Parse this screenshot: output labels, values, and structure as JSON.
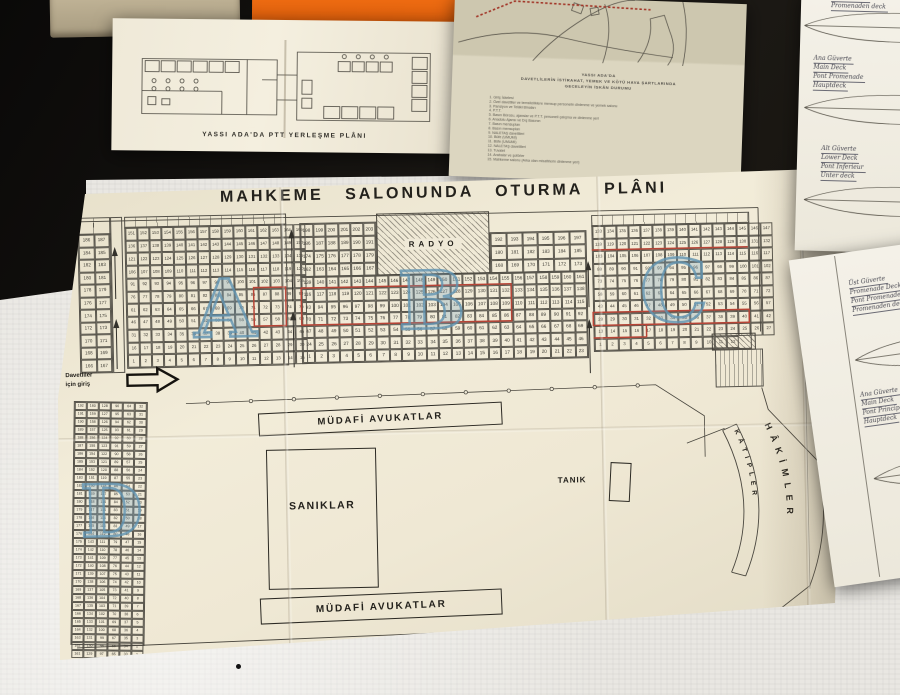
{
  "scene": {
    "colors": {
      "table_dark": "#161310",
      "cloth_light": "#e9e7e2",
      "folder_orange": "#e86410",
      "book_tan": "#b3a78d",
      "plan_paper": "#efe8d4",
      "red_mark": "#b84436",
      "blue_stamp": "#6fa0bd"
    }
  },
  "ptt_plan": {
    "caption": "YASSI ADA'DA PTT YERLEŞME PLÂNI"
  },
  "info_sheet": {
    "heading": [
      "YASSI ADA'DA",
      "DAVETLİLERİN İSTİRAHAT, YEMEK VE KÖTÜ HAVA ŞARTLARINDA",
      "GECELEYİN İSKÂN DURUMU"
    ],
    "items": [
      "Giriş İskelesi",
      "Özel davetliler ve temsilciliklere mensup personelin dinlenme ve yemek salonu",
      "Pansiyon ve Telâki Binaları",
      "P.T.T.",
      "Basın Bürosu, ajanslar ve P.T.T. personeli çalışma ve dinlenme yeri",
      "Anadolu Ajansı ve Dış Basının",
      "Basın mensupları",
      "Basın mensupları",
      "NALETAŞ davetlileri",
      "Büfe (UMUMİ)",
      "Büfe (UMUMİ)",
      "NALETAŞ davetlileri",
      "Tuvalet",
      "Arabalar ve şoförler",
      "Mahkeme salonu (Arka olan misafirlerin dinlenme yeri)"
    ]
  },
  "court_plan": {
    "title": "MAHKEME SALONUNDA OTURMA PLÂNI",
    "entrance_line1": "Davetliler",
    "entrance_line2": "için giriş",
    "radyo_label": "RADYO",
    "saniklar_label": "SANIKLAR",
    "tanik_label": "TANIK",
    "mudafi_top_label": "MÜDAFİ AVUKATLAR",
    "mudafi_bottom_label": "MÜDAFİ AVUKATLAR",
    "hakimler_label": "HÂKİMLER",
    "katipler_label": "KÂTİPLER",
    "stamp_a": "A",
    "stamp_b": "B",
    "stamp_c": "C",
    "stamp_d": "D",
    "grids": {
      "a_pairs": {
        "cols": 2,
        "row_ranges": [
          [
            186,
            187
          ],
          [
            184,
            185
          ],
          [
            182,
            183
          ],
          [
            180,
            181
          ],
          [
            178,
            179
          ],
          [
            176,
            177
          ],
          [
            174,
            175
          ],
          [
            172,
            173
          ],
          [
            170,
            171
          ],
          [
            168,
            169
          ],
          [
            166,
            167
          ]
        ]
      },
      "a_main": {
        "cols": 15,
        "row_ranges": [
          [
            151,
            165
          ],
          [
            136,
            150
          ],
          [
            121,
            135
          ],
          [
            106,
            120
          ],
          [
            91,
            105
          ],
          [
            76,
            90
          ],
          [
            61,
            75
          ],
          [
            46,
            60
          ],
          [
            31,
            45
          ],
          [
            16,
            30
          ],
          [
            1,
            15
          ]
        ]
      },
      "b_upper_left": {
        "cols": 6,
        "row_ranges": [
          [
            198,
            203
          ],
          [
            186,
            191
          ],
          [
            174,
            179
          ],
          [
            162,
            167
          ]
        ]
      },
      "b_upper_right": {
        "cols": 6,
        "row_ranges": [
          [
            192,
            197
          ],
          [
            180,
            185
          ],
          [
            168,
            173
          ]
        ]
      },
      "b_main": {
        "cols": 23,
        "row_ranges": [
          [
            139,
            161
          ],
          [
            116,
            138
          ],
          [
            93,
            115
          ],
          [
            70,
            92
          ],
          [
            47,
            69
          ],
          [
            24,
            46
          ],
          [
            1,
            23
          ]
        ]
      },
      "c_main": {
        "cols": 15,
        "row_ranges": [
          [
            133,
            147
          ],
          [
            118,
            132
          ],
          [
            103,
            117
          ],
          [
            88,
            102
          ],
          [
            73,
            87
          ],
          [
            58,
            72
          ],
          [
            43,
            57
          ],
          [
            28,
            42
          ],
          [
            13,
            27
          ],
          [
            1,
            12
          ]
        ]
      },
      "d_main": {
        "cols": 6,
        "col_tops": [
          192,
          160,
          128,
          96,
          64,
          32
        ],
        "row_count": 32
      }
    }
  },
  "deck_sheet_top": {
    "blocks": {
      "b1": [
        "Üst Güverte",
        "Promenaden deck"
      ],
      "b2": [
        "Ana Güverte",
        "Main Deck",
        "Pont Promenade",
        "Hauptdeck"
      ],
      "b3": [
        "Alt Güverte",
        "Lower Deck",
        "Pont Inferieur",
        "Unter deck"
      ]
    }
  },
  "deck_sheet_bottom": {
    "blocks": {
      "b1": [
        "Üst Güverte",
        "Promenade Deck",
        "Pont Promenade",
        "Promenaden deck"
      ],
      "b2": [
        "Ana Güverte",
        "Main Deck",
        "Pont Principal",
        "Hauptdeck"
      ],
      "b3": [
        "Alt Güverte",
        "Lower Deck",
        "Pont Inferieur",
        "Unterdeck"
      ]
    }
  }
}
